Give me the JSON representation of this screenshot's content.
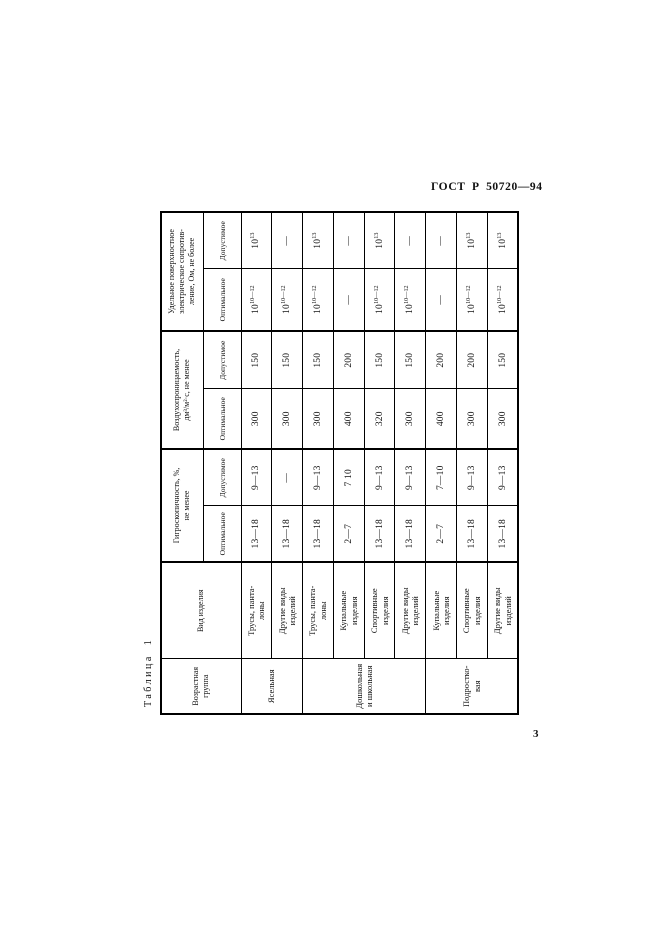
{
  "page": {
    "doc_code": "ГОСТ Р 50720—94",
    "page_number": "3",
    "table_label": "Таблица 1"
  },
  "table": {
    "header": {
      "age": "Возрастная\nгруппа",
      "product": "Вид изделия",
      "groups": [
        {
          "label": "Гигроскопичность, %,\nне менее",
          "sub": [
            "Оптимальное",
            "Допустимое"
          ]
        },
        {
          "label": "Воздухопроницаемость,\nдм³/м²·с, не менее",
          "sub": [
            "Оптимальное",
            "Допустимое"
          ]
        },
        {
          "label": "Удельное поверхностное\nэлектрическое сопротив-\nление, Ом, не более",
          "sub": [
            "Оптимальное",
            "Допустимое"
          ]
        }
      ]
    },
    "age_groups": [
      {
        "label": "Ясельная",
        "rows": 2
      },
      {
        "label": "Дошкольная\nи школьная",
        "rows": 4
      },
      {
        "label": "Подростко-\nвая",
        "rows": 3
      }
    ],
    "rows": [
      {
        "product": "Трусы, панта-\nлоны",
        "values": [
          "13—18",
          "9—13",
          "300",
          "150",
          "10^10—12",
          "10^13"
        ]
      },
      {
        "product": "Другие виды\nизделий",
        "values": [
          "13—18",
          "—",
          "300",
          "150",
          "10^10—12",
          "—"
        ]
      },
      {
        "product": "Трусы, панта-\nлоны",
        "values": [
          "13—18",
          "9—13",
          "300",
          "150",
          "10^10—12",
          "10^13"
        ]
      },
      {
        "product": "Купальные\nизделия",
        "values": [
          "2—7",
          "7 10",
          "400",
          "200",
          "—",
          "—"
        ]
      },
      {
        "product": "Спортивные\nизделия",
        "values": [
          "13—18",
          "9—13",
          "320",
          "150",
          "10^10—12",
          "10^13"
        ]
      },
      {
        "product": "Другие виды\nизделий",
        "values": [
          "13—18",
          "9—13",
          "300",
          "150",
          "10^10—12",
          "—"
        ]
      },
      {
        "product": "Купальные\nизделия",
        "values": [
          "2—7",
          "7—10",
          "400",
          "200",
          "—",
          "—"
        ]
      },
      {
        "product": "Спортивные\nизделия",
        "values": [
          "13—18",
          "9—13",
          "300",
          "200",
          "10^10—12",
          "10^13"
        ]
      },
      {
        "product": "Другие виды\nизделий",
        "values": [
          "13—18",
          "9—13",
          "300",
          "150",
          "10^10—12",
          "10^13"
        ]
      }
    ],
    "column_widths": [
      55,
      97,
      56,
      57,
      60,
      58,
      62,
      57
    ]
  }
}
